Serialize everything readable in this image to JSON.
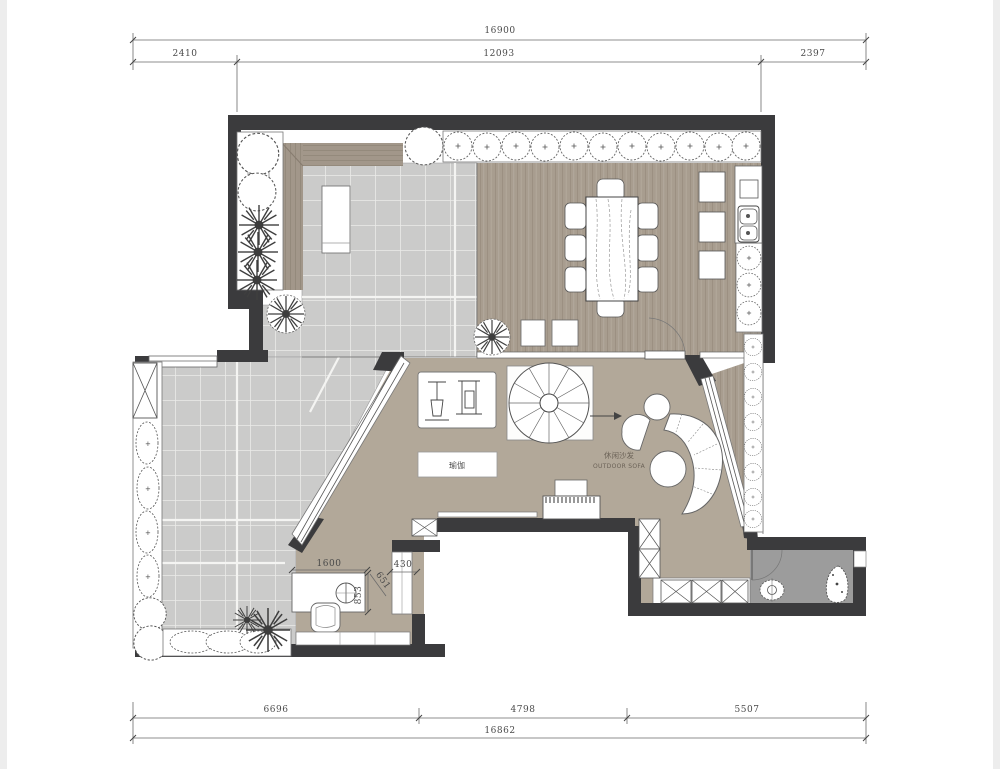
{
  "plan": {
    "type": "residential floor plan (top view CAD drawing)",
    "labels": {
      "sofa_cn": "休闲沙发",
      "sofa_en": "OUTDOOR SOFA",
      "yoga": "瑜伽"
    },
    "dimensions": {
      "top": {
        "total": "16900",
        "segments": [
          "2410",
          "12093",
          "2397"
        ]
      },
      "bottom": {
        "total": "16862",
        "segments": [
          "6696",
          "4798",
          "5507"
        ]
      },
      "interior": {
        "vanity_w": "1600",
        "door_w": "430",
        "vanity_d": "853",
        "diag": "651"
      }
    },
    "colors": {
      "wall": "#3b3b3d",
      "tile_floor": "#cbcbca",
      "wood_slat_floor": "#a89d8f",
      "living_floor": "#b2a899",
      "bath_floor": "#9c9c9c",
      "line": "#555555"
    },
    "icons": [
      "tree-icon",
      "shrub-icon",
      "hedge-icon",
      "planter-icon",
      "spiral-staircase-icon",
      "dining-table-icon",
      "chair-icon",
      "cabinet-icon",
      "sink-icon",
      "curved-sofa-icon",
      "pouf-icon",
      "gym-equipment-icon",
      "tv-console-icon",
      "lounger-icon",
      "vanity-icon",
      "toilet-icon",
      "armchair-icon",
      "column-icon",
      "door-swing-icon",
      "dimension-arrow-icon"
    ]
  }
}
